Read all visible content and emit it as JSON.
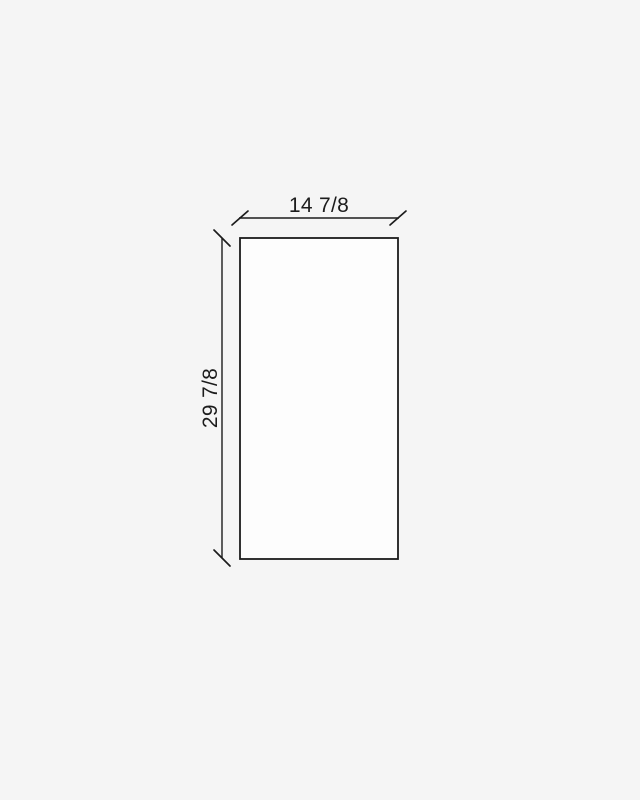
{
  "diagram": {
    "type": "dimensioned-panel-drawing",
    "width_dimension": {
      "label": "14 7/8",
      "orientation": "horizontal",
      "position": "above-panel"
    },
    "height_dimension": {
      "label": "29 7/8",
      "orientation": "vertical",
      "position": "left-of-panel"
    }
  },
  "colors": {
    "background": "#f5f5f5",
    "panel_fill": "#fdfdfd",
    "line": "#1c1c1c",
    "text": "#1c1c1c"
  }
}
